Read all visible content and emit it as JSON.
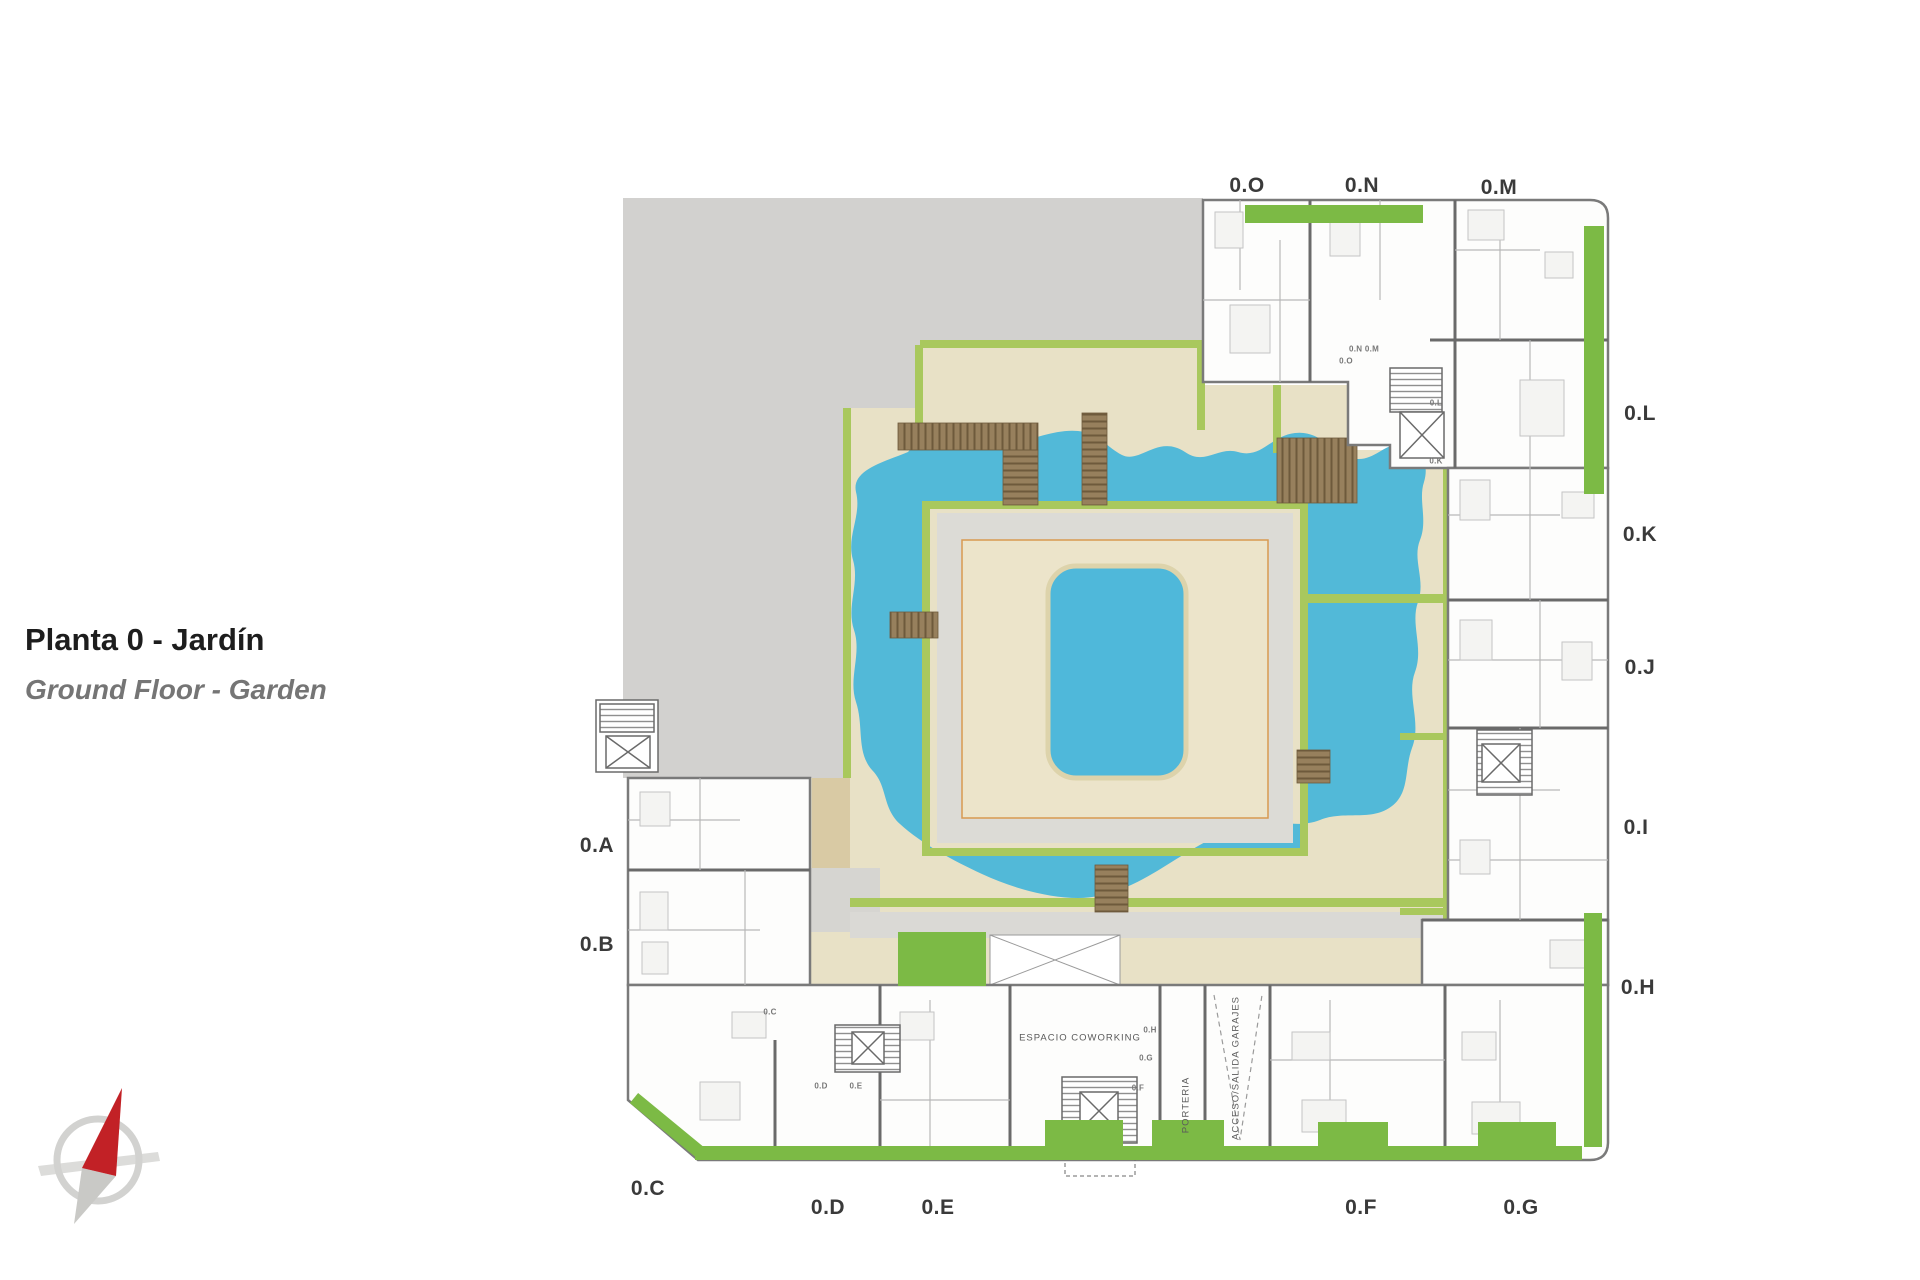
{
  "titles": {
    "primary": "Planta 0 - Jardín",
    "secondary": "Ground Floor - Garden"
  },
  "units": {
    "top": [
      "0.O",
      "0.N",
      "0.M"
    ],
    "right": [
      "0.L",
      "0.K",
      "0.J",
      "0.I",
      "0.H"
    ],
    "left": [
      "0.A",
      "0.B"
    ],
    "bottom": [
      "0.C",
      "0.D",
      "0.E",
      "0.F",
      "0.G"
    ]
  },
  "interior_texts": {
    "coworking": "ESPACIO COWORKING",
    "porteria": "PORTERIA",
    "garaje": "ACCESO/SALIDA GARAJES"
  },
  "interior_labels": [
    "0.N 0.M",
    "0.O",
    "0.L",
    "0.K",
    "0.C",
    "0.D",
    "0.E",
    "0.H",
    "0.G",
    "0.F"
  ],
  "compass": {
    "icon": "north-compass",
    "needle_color": "#c22126"
  },
  "colors": {
    "vacant_lot_gray": "#d2d1cf",
    "courtyard_sand": "#e8e1c6",
    "pond_blue": "#52b9d8",
    "pool_blue": "#4fb8da",
    "platform_gray": "#dcdbd6",
    "platform_inset_tan": "#ece4ca",
    "inset_border_orange": "#d89a50",
    "hedge_olive": "#a9c85d",
    "garden_green": "#7cba45",
    "deck_brown": "#97805d",
    "wall_gray": "#7a7a7a",
    "label_gray": "#3a3a3a"
  }
}
